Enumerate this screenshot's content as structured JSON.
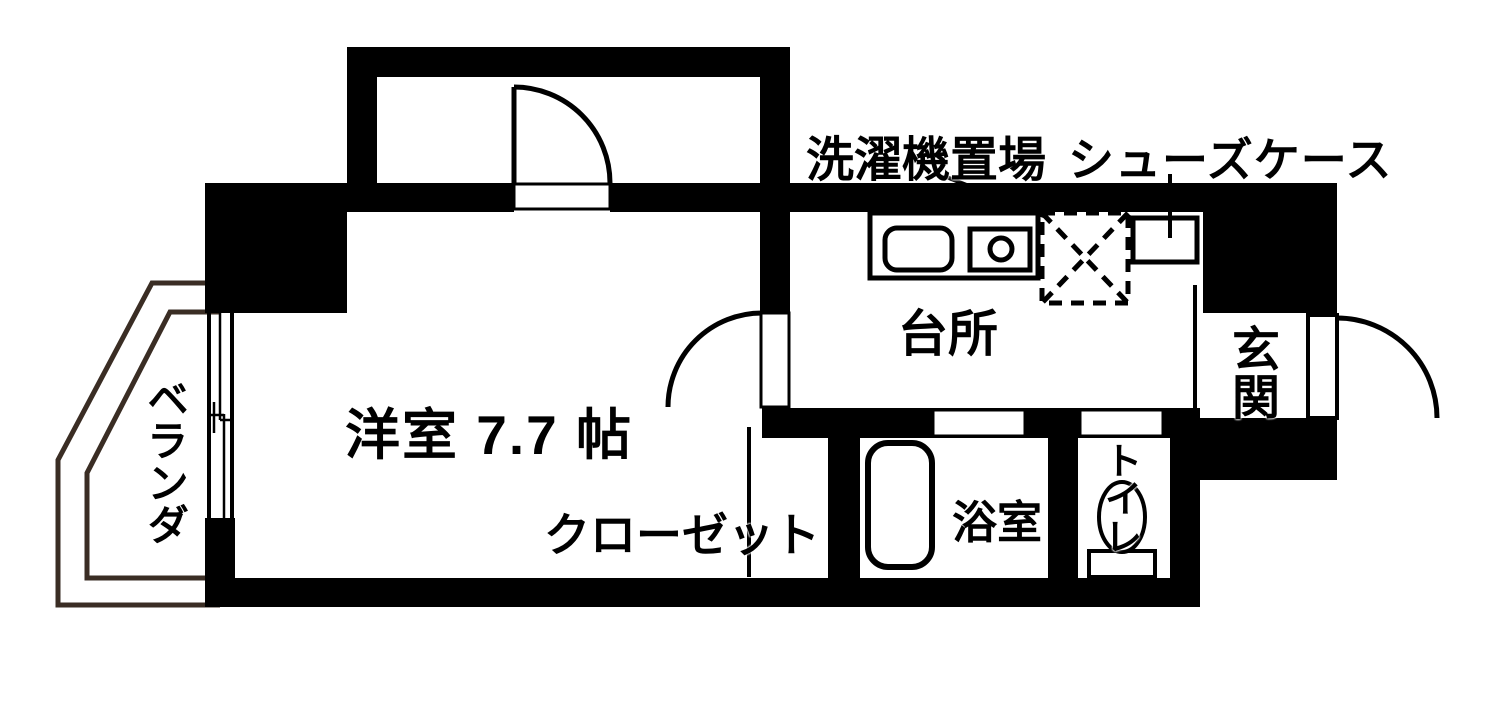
{
  "rooms": {
    "main_room": {
      "label": "洋室 7.7 帖"
    },
    "closet": {
      "label": "クローゼット"
    },
    "kitchen": {
      "label": "台所"
    },
    "bathroom": {
      "label": "浴室"
    },
    "toilet": {
      "label": "トイレ"
    },
    "entrance": {
      "label": "玄関"
    },
    "veranda": {
      "label": "ベランダ"
    }
  },
  "annotations": {
    "washer_area": {
      "label": "洗濯機置場"
    },
    "shoe_case": {
      "label": "シューズケース"
    }
  },
  "colors": {
    "wall": "#000000",
    "floor": "#ffffff",
    "veranda_line": "#3a2d24"
  }
}
